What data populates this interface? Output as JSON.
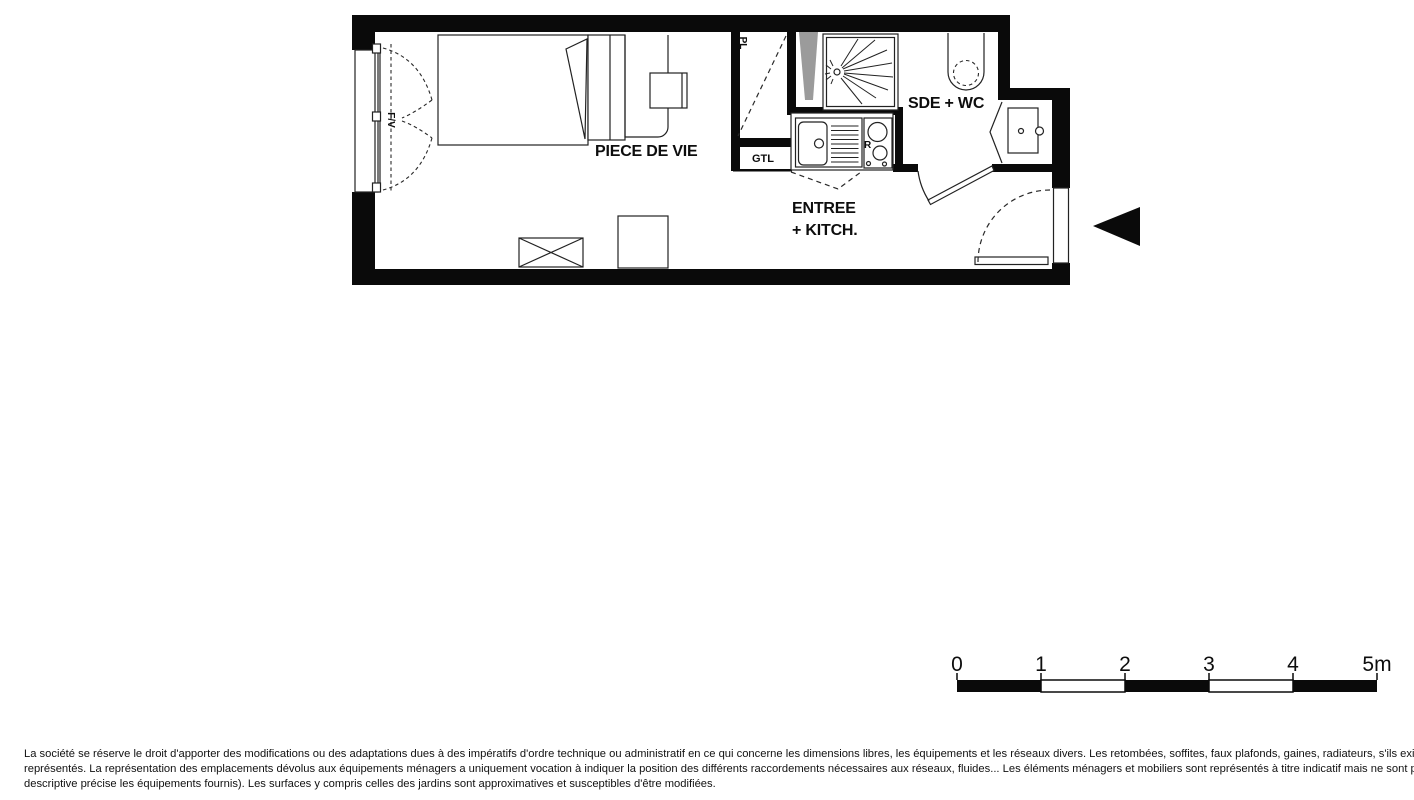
{
  "floor_plan": {
    "room_labels": {
      "living_room": "PIECE DE VIE",
      "bathroom": "SDE + WC",
      "entry_line1": "ENTREE",
      "entry_line2": "+ KITCH.",
      "closet": "PL",
      "technical_duct": "GTL",
      "fridge": "R",
      "window": "F/V"
    },
    "colors": {
      "wall": "#0a0a0a",
      "duct_fill": "#9b9b9b",
      "arrow": "#0a0a0a"
    }
  },
  "scale_bar": {
    "labels": [
      "0",
      "1",
      "2",
      "3",
      "4",
      "5m"
    ]
  },
  "disclaimer": {
    "lines": [
      "La société se réserve le droit d'apporter des modifications ou des adaptations dues à des impératifs d'ordre technique ou administratif en ce qui concerne les dimensions libres, les équipements et les réseaux divers. Les retombées, soffites, faux plafonds, gaines, radiateurs, s'ils existent, ne sont pas tous",
      "représentés. La représentation des emplacements dévolus aux équipements ménagers a uniquement vocation à indiquer la position des différents raccordements nécessaires aux réseaux, fluides... Les éléments ménagers et mobiliers sont représentés à titre indicatif mais ne sont pas tous fournis (seule la notice",
      "descriptive précise les équipements fournis). Les surfaces y compris celles des jardins sont approximatives et susceptibles d'être modifiées."
    ]
  }
}
